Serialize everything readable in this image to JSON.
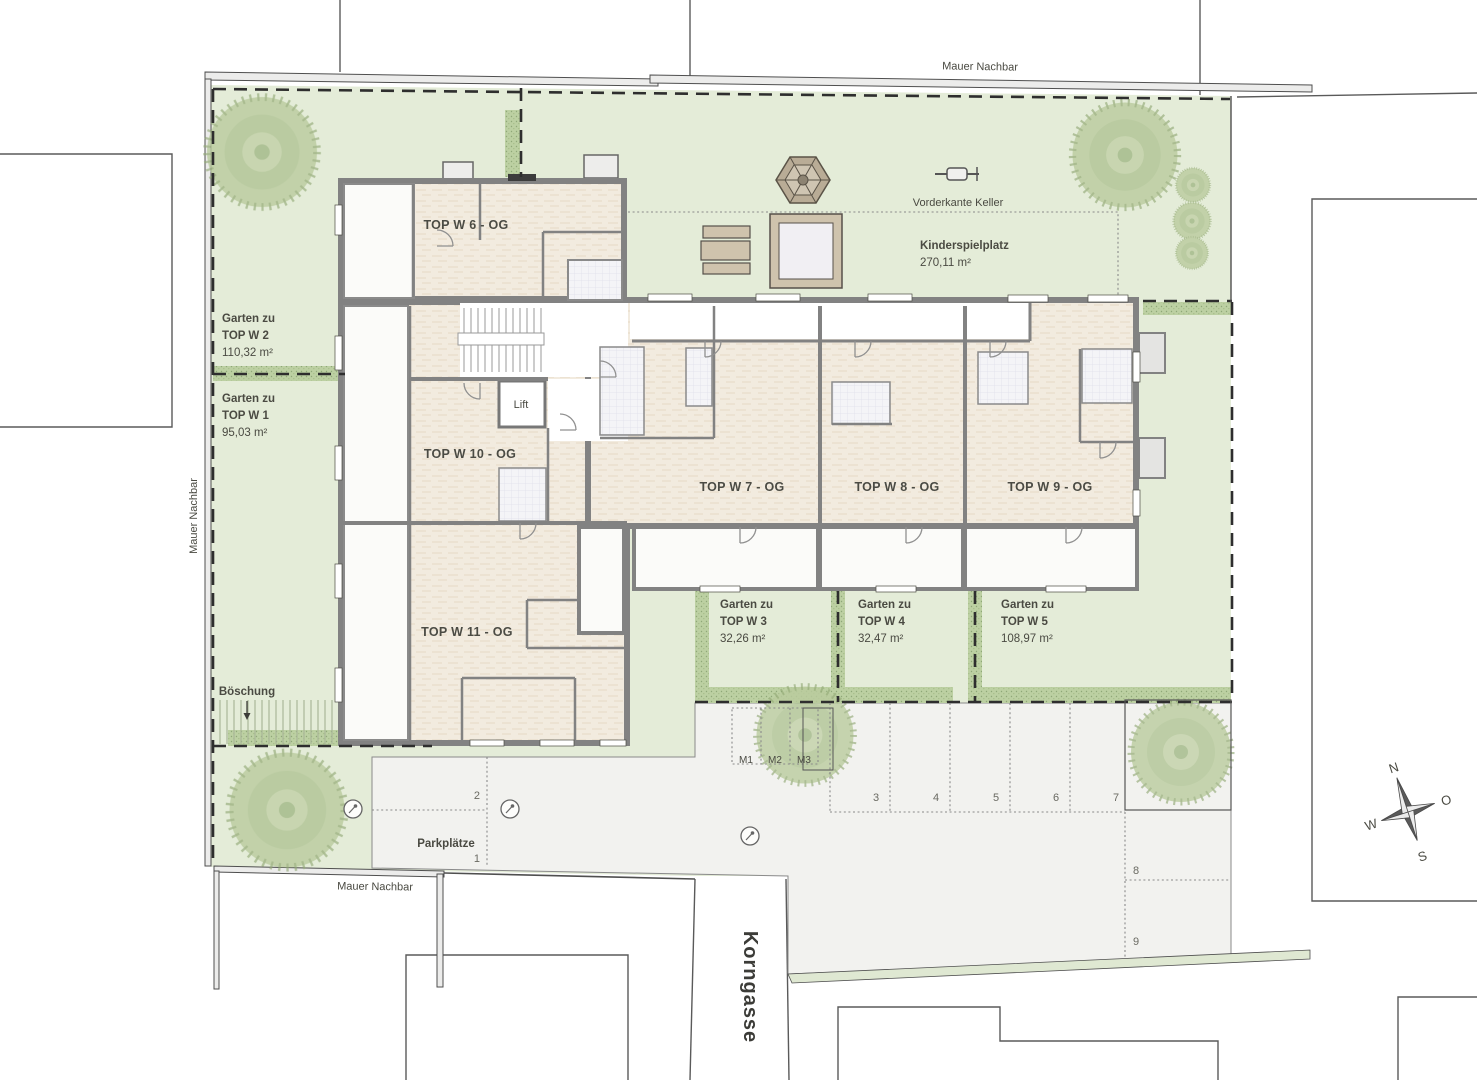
{
  "site": {
    "wall_top": "Mauer Nachbar",
    "wall_left": "Mauer Nachbar",
    "wall_bottom": "Mauer Nachbar",
    "street": "Korngasse",
    "keller_line": "Vorderkante Keller",
    "slope": "Böschung"
  },
  "playground": {
    "title": "Kinderspielplatz",
    "area": "270,11 m²"
  },
  "apartments": {
    "w6": "TOP W 6 - OG",
    "w7": "TOP W 7 - OG",
    "w8": "TOP W 8 - OG",
    "w9": "TOP W 9 - OG",
    "w10": "TOP W 10 - OG",
    "w11": "TOP W 11 - OG",
    "lift": "Lift"
  },
  "gardens": [
    {
      "line1": "Garten zu",
      "line2": "TOP W 2",
      "area": "110,32 m²"
    },
    {
      "line1": "Garten zu",
      "line2": "TOP W 1",
      "area": "95,03 m²"
    },
    {
      "line1": "Garten zu",
      "line2": "TOP W 3",
      "area": "32,26 m²"
    },
    {
      "line1": "Garten zu",
      "line2": "TOP W 4",
      "area": "32,47 m²"
    },
    {
      "line1": "Garten zu",
      "line2": "TOP W 5",
      "area": "108,97 m²"
    }
  ],
  "parking": {
    "label": "Parkplätze",
    "spaces": [
      "1",
      "2",
      "3",
      "4",
      "5",
      "6",
      "7",
      "8",
      "9"
    ],
    "moped": [
      "M1",
      "M2",
      "M3"
    ]
  },
  "compass": {
    "n": "N",
    "e": "O",
    "s": "S",
    "w": "W"
  },
  "colors": {
    "site_green": "#e4ecd8",
    "hedge": "#bccfa2",
    "room": "#f2ebdf",
    "wall": "#828282",
    "pavement": "#f2f2ef",
    "boundary": "#2e2e2e"
  }
}
